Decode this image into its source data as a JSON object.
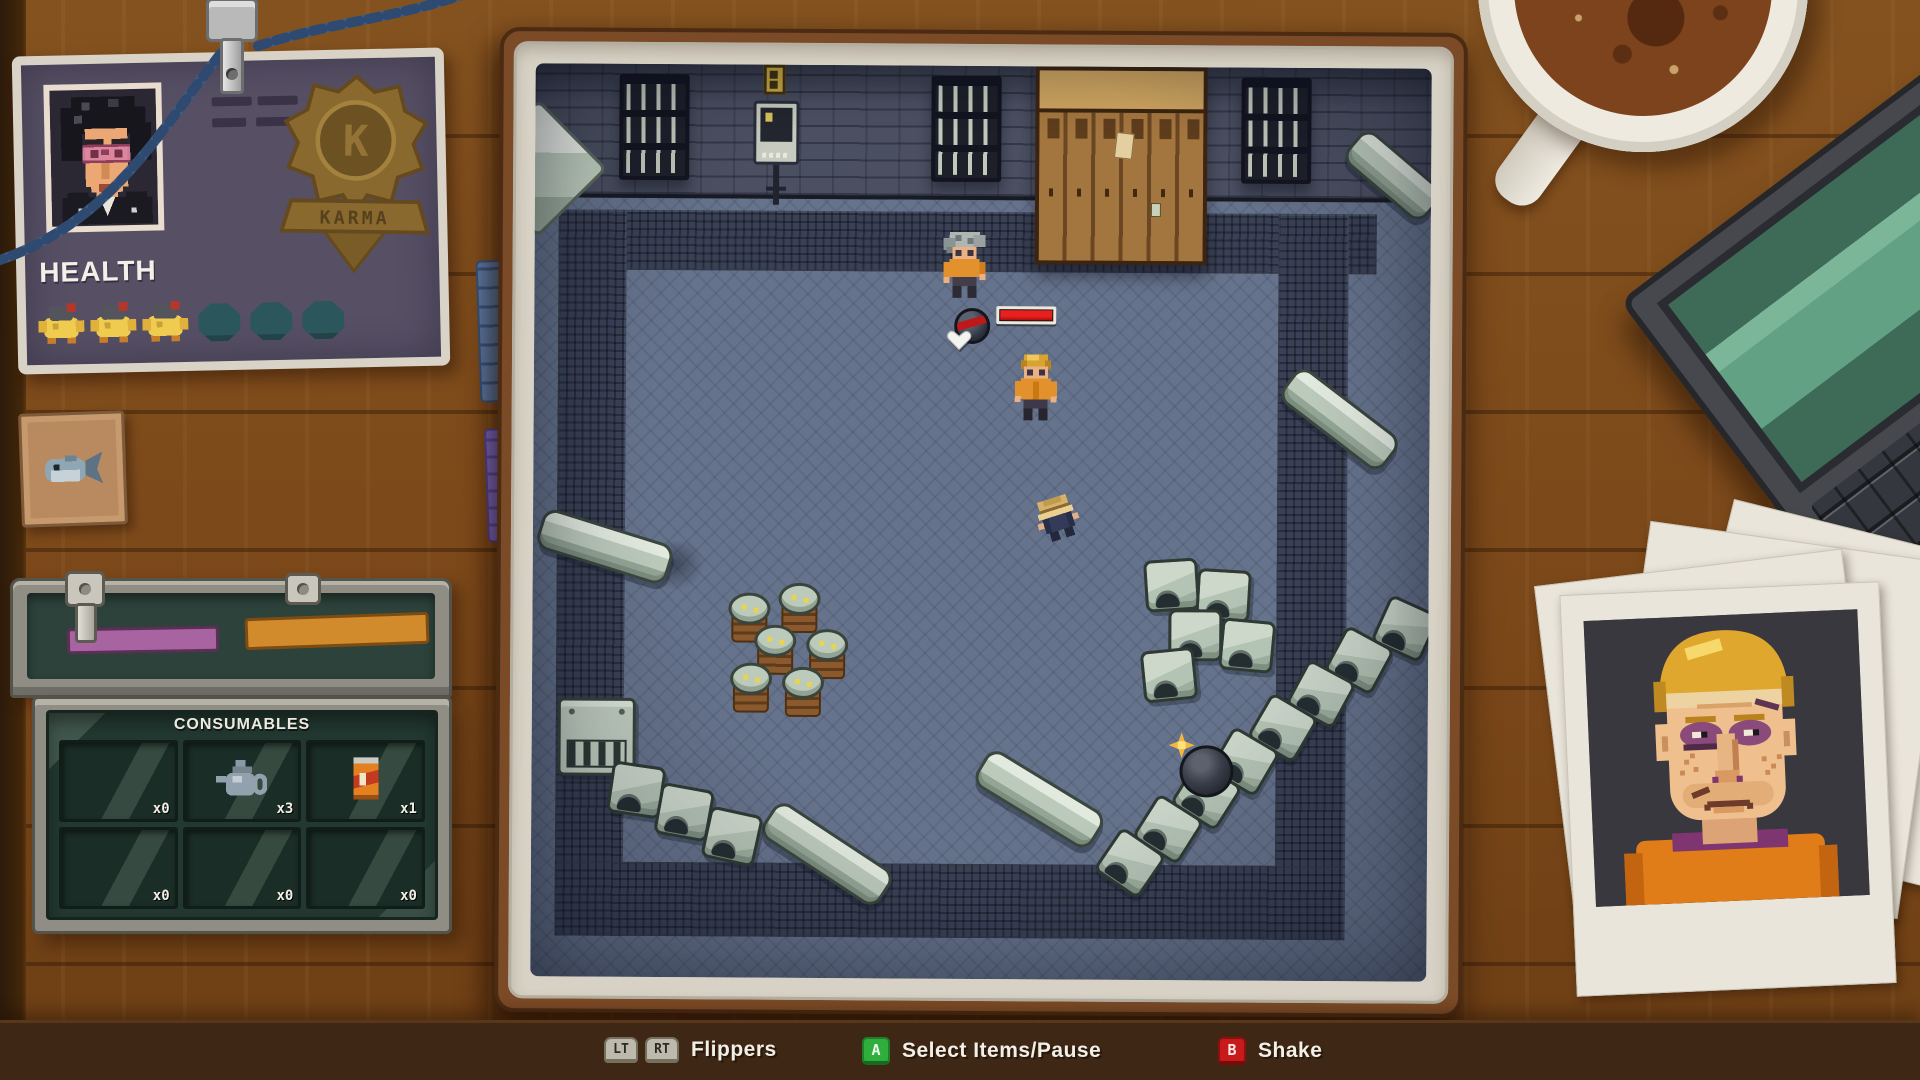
{
  "hud": {
    "health_card": {
      "title": "HEALTH",
      "health_filled": 3,
      "health_empty": 3,
      "badge_letter": "K",
      "badge_banner": "KARMA"
    },
    "inventory": {
      "title": "CONSUMABLES",
      "slots": [
        {
          "item": "empty",
          "count": "x0"
        },
        {
          "item": "teapot",
          "count": "x3"
        },
        {
          "item": "soda-can",
          "count": "x1"
        },
        {
          "item": "empty",
          "count": "x0"
        },
        {
          "item": "empty",
          "count": "x0"
        },
        {
          "item": "empty",
          "count": "x0"
        }
      ]
    }
  },
  "hint_bar": {
    "hints": [
      {
        "keys": [
          "LT",
          "RT"
        ],
        "action": "Flippers"
      },
      {
        "keys": [
          "A"
        ],
        "action": "Select Items/Pause"
      },
      {
        "keys": [
          "B"
        ],
        "action": "Shake"
      }
    ]
  },
  "colors": {
    "button_a": "#2fae3e",
    "button_b": "#c71a1a",
    "trigger_key": "#bdb9ad",
    "health_bar_fill": "#e82020",
    "prisoner_orange": "#e2912c",
    "bumper_sage": "#bccabb",
    "floor_blue": "#66738c",
    "card_purple": "#575065"
  }
}
